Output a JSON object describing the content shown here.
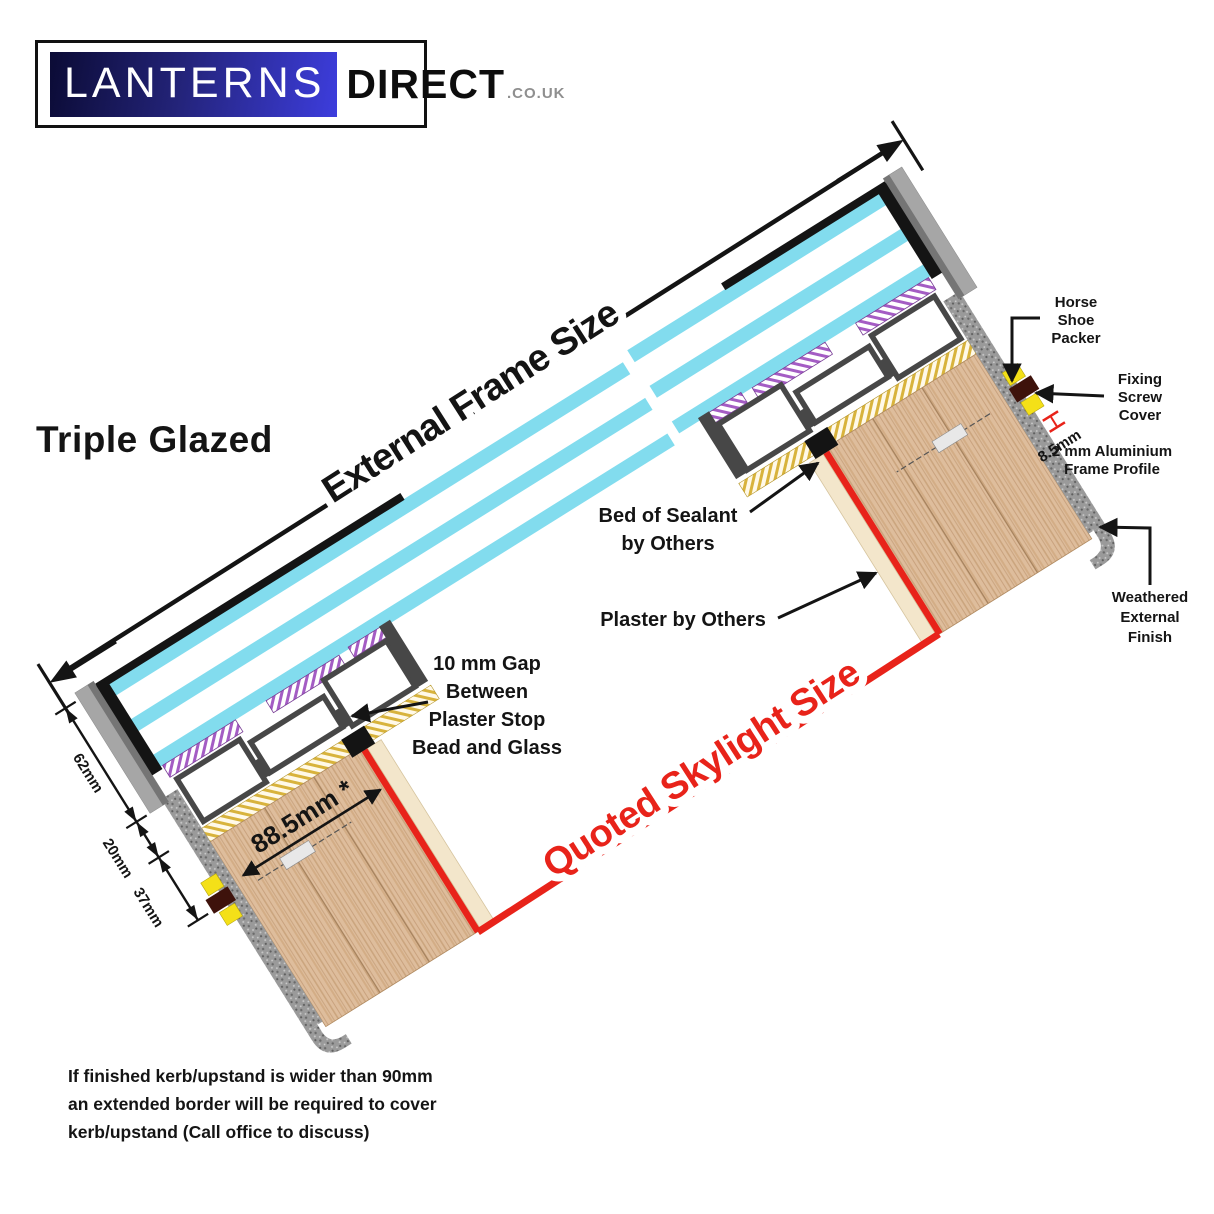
{
  "logo": {
    "brand_primary": "LANTERNS",
    "brand_secondary": "DIRECT",
    "brand_tld": ".CO.UK"
  },
  "title": "Triple Glazed",
  "dimensions": {
    "external_frame_size": "External Frame Size",
    "quoted_skylight_size": "Quoted Skylight Size",
    "kerb_top_width": "88.5mm *",
    "glass_unit_height": "62mm",
    "frame_base_height": "20mm",
    "kerb_reveal_height": "37mm",
    "profile_wall": "8.5mm"
  },
  "callouts": {
    "horse_shoe_packer": [
      "Horse",
      "Shoe",
      "Packer"
    ],
    "fixing_screw_cover": [
      "Fixing",
      "Screw",
      "Cover"
    ],
    "aluminium_frame_profile": [
      "2 mm Aluminium",
      "Frame Profile"
    ],
    "weathered_external_finish": [
      "Weathered",
      "External",
      "Finish"
    ],
    "bed_of_sealant": [
      "Bed of Sealant",
      "by Others"
    ],
    "plaster_by_others": [
      "Plaster by Others"
    ],
    "plaster_gap": [
      "10 mm Gap",
      "Between",
      "Plaster Stop",
      "Bead and Glass"
    ]
  },
  "footnote": [
    "If finished kerb/upstand is wider than 90mm",
    "an extended border will be required to cover",
    "kerb/upstand (Call office to discuss)"
  ],
  "colors": {
    "glass_cyan": "#82DCEE",
    "frame_dark_grey": "#474747",
    "capping_grey": "#A6A6A6",
    "wood_kerb": "#DEBD9C",
    "quoted_line_red": "#E8231A",
    "packer_yellow": "#F4E018",
    "sealant_gold": "#D8B33C",
    "glazing_tape_purple": "#A45CC4",
    "plaster_cream": "#F3E6CB",
    "weathered_grey": "#9A9A9A",
    "logo_blue": "#2A2AB0"
  }
}
